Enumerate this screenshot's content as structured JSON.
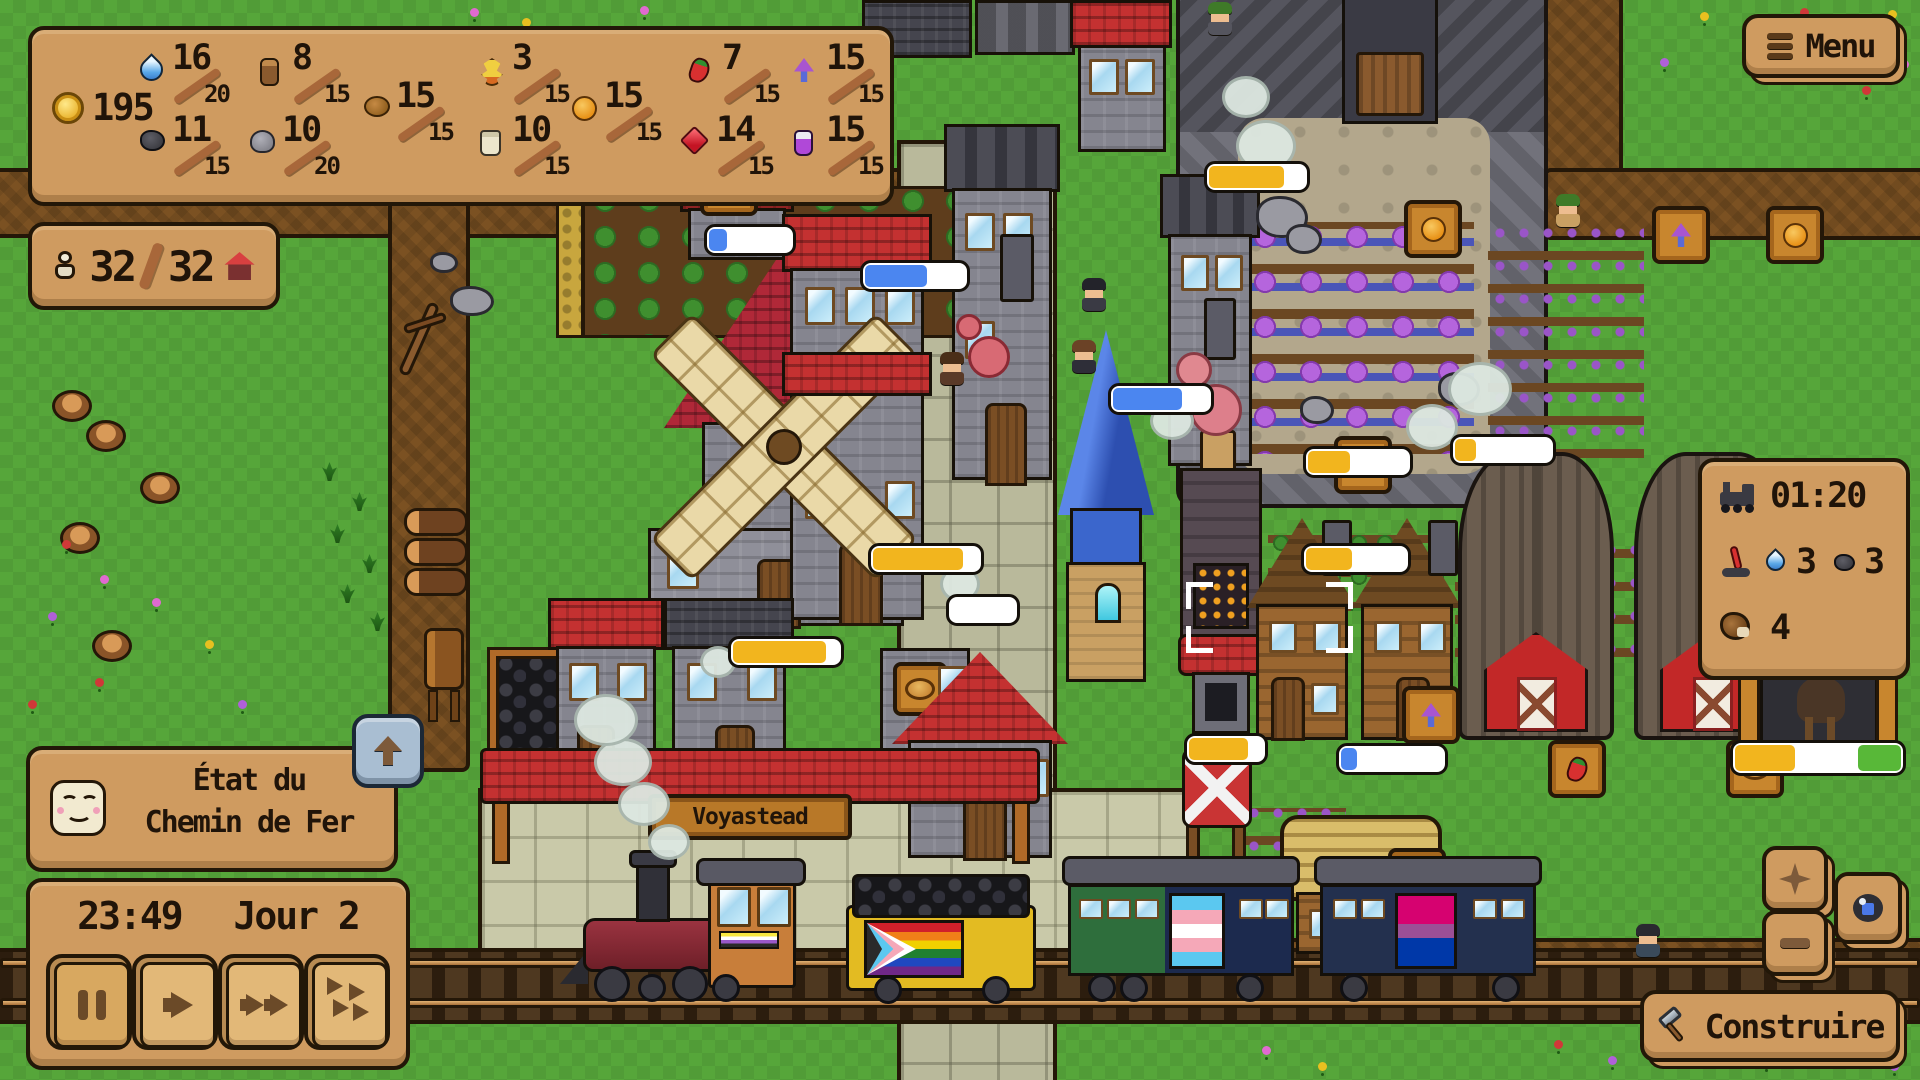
{
  "ui": {
    "resources": {
      "coins": "195",
      "items": [
        {
          "icon": "water-drop",
          "value": "16",
          "max": "20"
        },
        {
          "icon": "log",
          "value": "8",
          "max": "15"
        },
        {
          "icon": "hops",
          "value": "3",
          "max": "15"
        },
        {
          "icon": "chili-pepper",
          "value": "7",
          "max": "15"
        },
        {
          "icon": "purple-mushroom",
          "value": "15",
          "max": "15"
        },
        {
          "icon": "clay",
          "value": "15",
          "max": "15"
        },
        {
          "icon": "orange",
          "value": "15",
          "max": "15"
        },
        {
          "icon": "coal",
          "value": "11",
          "max": "15"
        },
        {
          "icon": "stone",
          "value": "10",
          "max": "20"
        },
        {
          "icon": "flour-sack",
          "value": "10",
          "max": "15"
        },
        {
          "icon": "ruby",
          "value": "14",
          "max": "15"
        },
        {
          "icon": "potion",
          "value": "15",
          "max": "15"
        }
      ]
    },
    "population": {
      "current": "32",
      "max": "32",
      "icons": [
        "villager-icon",
        "house-icon"
      ]
    },
    "menu_button": {
      "label": "Menu",
      "icon": "hamburger-icon"
    },
    "train_panel": {
      "arrival_time": "01:20",
      "water": "3",
      "coal": "3",
      "cargo": "4",
      "icons": [
        "locomotive-icon",
        "switch-lever-icon",
        "water-drop-icon",
        "coal-icon",
        "saddlebag-icon"
      ]
    },
    "railroad_status": {
      "line1": "État du",
      "line2": "Chemin de Fer",
      "icon": "happy-face-icon",
      "expand_icon": "up-arrow-icon"
    },
    "clock_panel": {
      "time": "23:49",
      "day": "Jour 2",
      "buttons": [
        {
          "name": "pause",
          "icon": "pause-icon"
        },
        {
          "name": "play",
          "icon": "play-icon"
        },
        {
          "name": "fast-forward",
          "icon": "fast-forward-icon"
        },
        {
          "name": "max-speed",
          "icon": "triple-arrow-icon"
        }
      ]
    },
    "build_button": {
      "label": "Construire",
      "icon": "hammer-icon"
    },
    "map_buttons": [
      {
        "name": "zoom-in",
        "icon": "diamond-plus-icon"
      },
      {
        "name": "zoom-out",
        "icon": "minus-icon"
      },
      {
        "name": "camera",
        "icon": "camera-icon"
      }
    ],
    "colors": {
      "panel": "#cf9b60",
      "panel_border": "#221708",
      "text": "#201409",
      "bar_yellow": "#f2b51e",
      "bar_blue": "#4b86f0",
      "grass": "#56a63a"
    }
  },
  "world": {
    "station_sign": "Voyastead"
  }
}
